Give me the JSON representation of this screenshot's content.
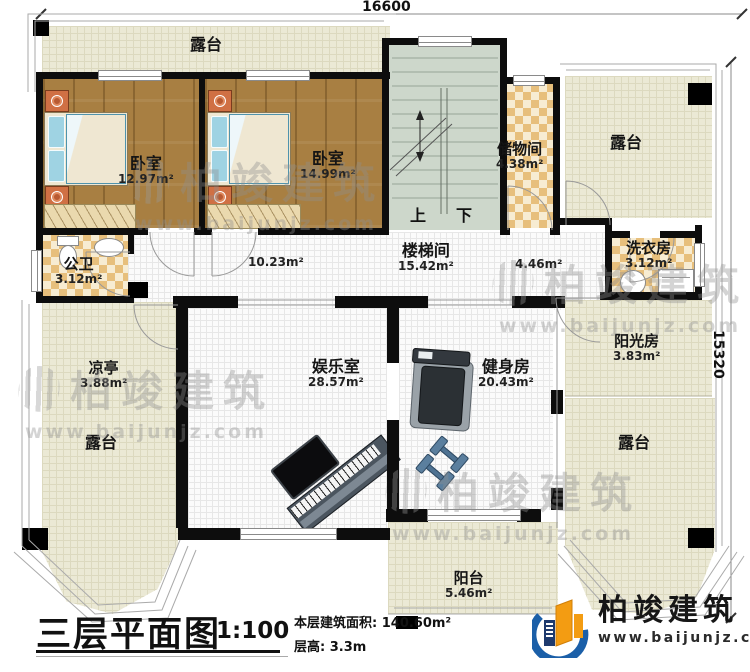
{
  "dimensions": {
    "top": "16600",
    "right": "15320"
  },
  "rooms": {
    "terrace_top": {
      "label": "露台"
    },
    "terrace_top_right": {
      "label": "露台"
    },
    "bedroom1": {
      "label": "卧室",
      "area": "12.97m²"
    },
    "bedroom2": {
      "label": "卧室",
      "area": "14.99m²"
    },
    "stairwell": {
      "label": "楼梯间",
      "area": "15.42m²",
      "up": "上",
      "down": "下"
    },
    "storage": {
      "label": "储物间",
      "area": "4.38m²"
    },
    "laundry": {
      "label": "洗衣房",
      "area": "3.12m²"
    },
    "bathroom": {
      "label": "公卫",
      "area": "3.12m²"
    },
    "hall_left": {
      "area": "10.23m²"
    },
    "hall_right": {
      "area": "4.46m²"
    },
    "pavilion": {
      "label": "凉亭",
      "area": "3.88m²"
    },
    "terrace_left": {
      "label": "露台"
    },
    "entertainment": {
      "label": "娱乐室",
      "area": "28.57m²"
    },
    "gym": {
      "label": "健身房",
      "area": "20.43m²"
    },
    "sunroom": {
      "label": "阳光房",
      "area": "3.83m²"
    },
    "terrace_right": {
      "label": "露台"
    },
    "balcony": {
      "label": "阳台",
      "area": "5.46m²"
    }
  },
  "title_block": {
    "title": "三层平面图",
    "scale": "1:100",
    "area": "本层建筑面积: 140.60m²",
    "floor_height": "层高: 3.3m"
  },
  "brand": {
    "name": "柏竣建筑",
    "website": "www.baijunjz.com"
  },
  "watermark": {
    "name": "柏竣建筑",
    "website": "www.baijunjz.com"
  }
}
